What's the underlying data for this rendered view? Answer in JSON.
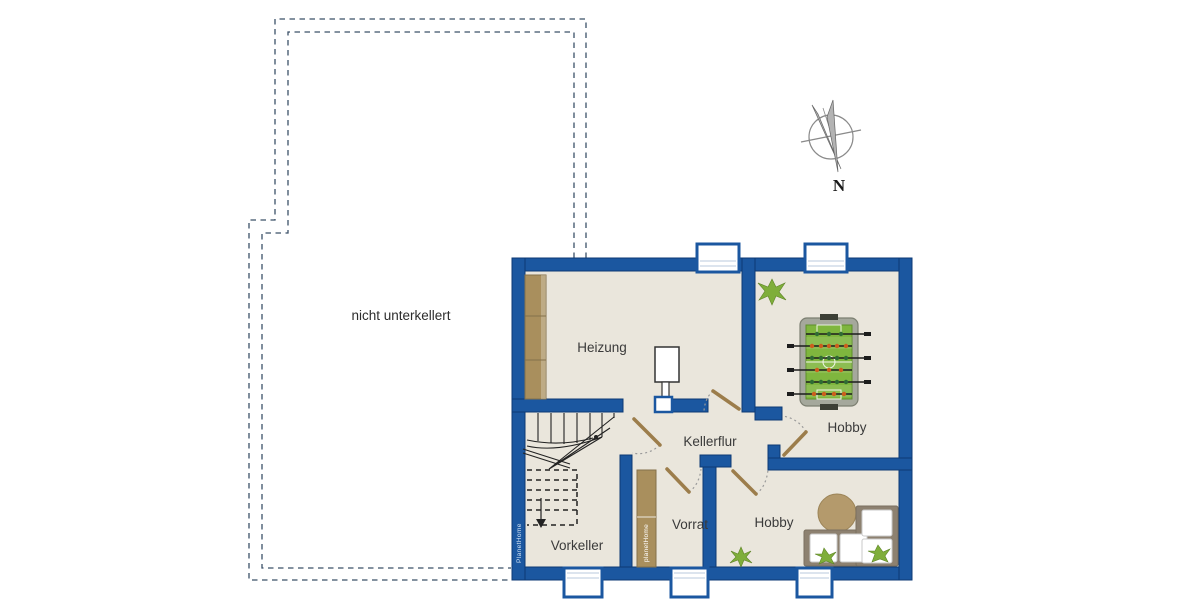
{
  "labels": {
    "not_basemented": "nicht unterkellert",
    "heizung": "Heizung",
    "kellerflur": "Kellerflur",
    "hobby_upper": "Hobby",
    "hobby_lower": "Hobby",
    "vorrat": "Vorrat",
    "vorkeller": "Vorkeller",
    "compass_north": "N"
  },
  "branding": {
    "wall_text": "PlanetHome",
    "shelf_text": "planetHome"
  },
  "rooms": [
    {
      "name": "Heizung",
      "furniture": [
        "shelf",
        "boiler"
      ]
    },
    {
      "name": "Kellerflur",
      "furniture": [
        "doors"
      ]
    },
    {
      "name": "Hobby",
      "furniture": [
        "foosball-table",
        "plant"
      ]
    },
    {
      "name": "Hobby",
      "furniture": [
        "corner-sofa",
        "round-rug",
        "plants"
      ]
    },
    {
      "name": "Vorrat",
      "furniture": [
        "shelf"
      ]
    },
    {
      "name": "Vorkeller",
      "furniture": [
        "winder-staircase"
      ]
    }
  ],
  "colors": {
    "wall-blue": "#1b57a0",
    "wall-outline": "#0d3a74",
    "floor": "#eae6dc",
    "wood": "#a98f5d",
    "wood-dark": "#84704a",
    "door-leaf": "#9c7d4b",
    "arc-gray": "#9a9a9a",
    "dashed-outline": "#3b5068",
    "label-text": "#3a3a3a",
    "window-line": "#b9c9dd",
    "stair-line": "#222222",
    "field-green": "#7fb63e",
    "player-dark": "#2f6b33",
    "player-orange": "#cc5f1d",
    "plant-green": "#7fae3a",
    "rug-brown": "#b49a6c",
    "sofa-frame": "#8d8170",
    "cushion": "#ffffff"
  }
}
